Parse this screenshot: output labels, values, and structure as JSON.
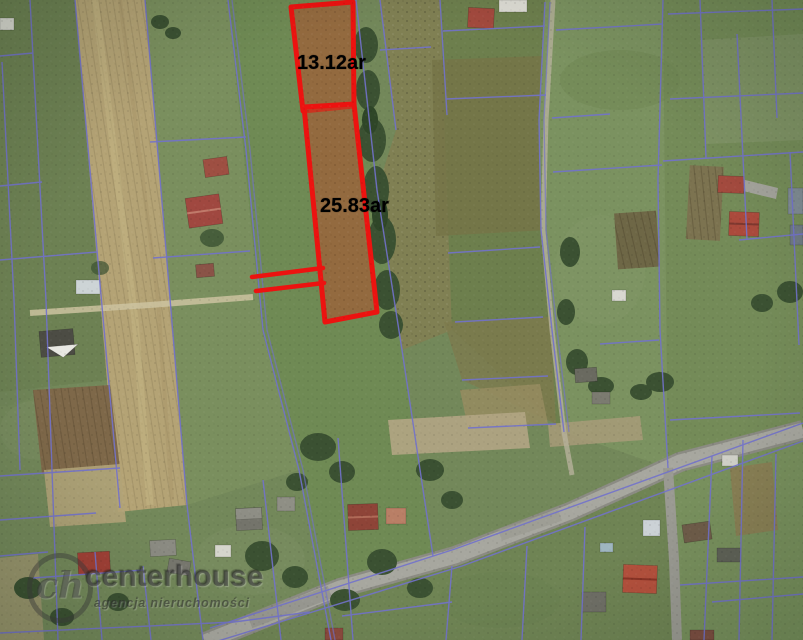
{
  "parcels": [
    {
      "area_label": "13.12ar"
    },
    {
      "area_label": "25.83ar"
    }
  ],
  "watermark": {
    "logo_initials": "ch",
    "brand": "centerhouse",
    "tagline": "agencja nieruchomości"
  },
  "colors": {
    "highlight_red": "#ec1310",
    "parcel_fill_red": "#b0502e",
    "boundary_blue": "#7272cc",
    "label_text": "#000000",
    "road_gray": "#a7a79f"
  }
}
